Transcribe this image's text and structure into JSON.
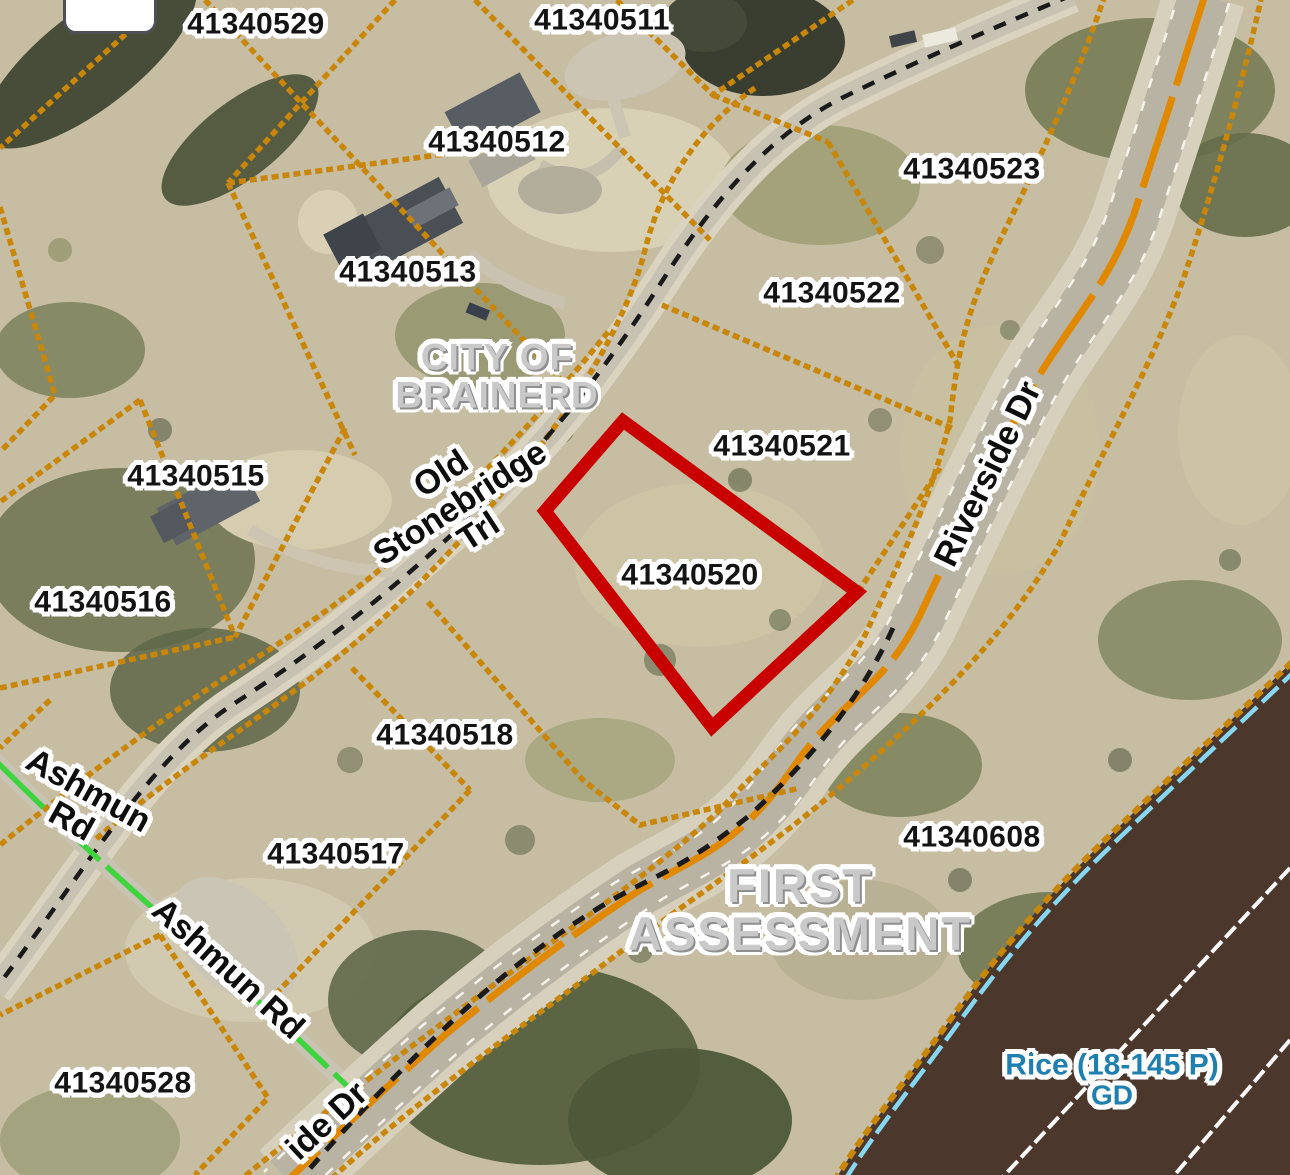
{
  "map": {
    "highlighted_parcel": "41340520",
    "city_label": {
      "line1": "CITY OF",
      "line2": "BRAINERD"
    },
    "plat_label": {
      "line1": "FIRST",
      "line2": "ASSESSMENT"
    },
    "water_label": {
      "line1": "Rice (18-145 P)",
      "line2": "GD"
    },
    "parcels": [
      {
        "id": "41340529"
      },
      {
        "id": "41340511"
      },
      {
        "id": "41340512"
      },
      {
        "id": "41340513"
      },
      {
        "id": "41340523"
      },
      {
        "id": "41340522"
      },
      {
        "id": "41340521"
      },
      {
        "id": "41340520"
      },
      {
        "id": "41340515"
      },
      {
        "id": "41340516"
      },
      {
        "id": "41340518"
      },
      {
        "id": "41340517"
      },
      {
        "id": "41340608"
      },
      {
        "id": "41340528"
      }
    ],
    "roads": {
      "old_stonebridge": {
        "line1": "Old",
        "line2": "Stonebridge",
        "line3": "Trl"
      },
      "riverside": "Riverside Dr",
      "riverside_partial": "ide Dr",
      "ashmun_upper": {
        "line1": "Ashmun",
        "line2": "Rd"
      },
      "ashmun_lower": "Ashmun Rd"
    },
    "colors": {
      "parcel_line": "#c8860a",
      "highlight_outline": "#c90000",
      "water": "#4b372c",
      "shoreline_water_line": "#86d7ef",
      "road_center_stripe": "#e08900",
      "ashmun_centerline": "#3dd43d",
      "boundary_dash": "#1a1a1a",
      "plat_text": "#c9c9c9",
      "water_text": "#1e7fb0",
      "parcel_text": "#141414"
    }
  }
}
